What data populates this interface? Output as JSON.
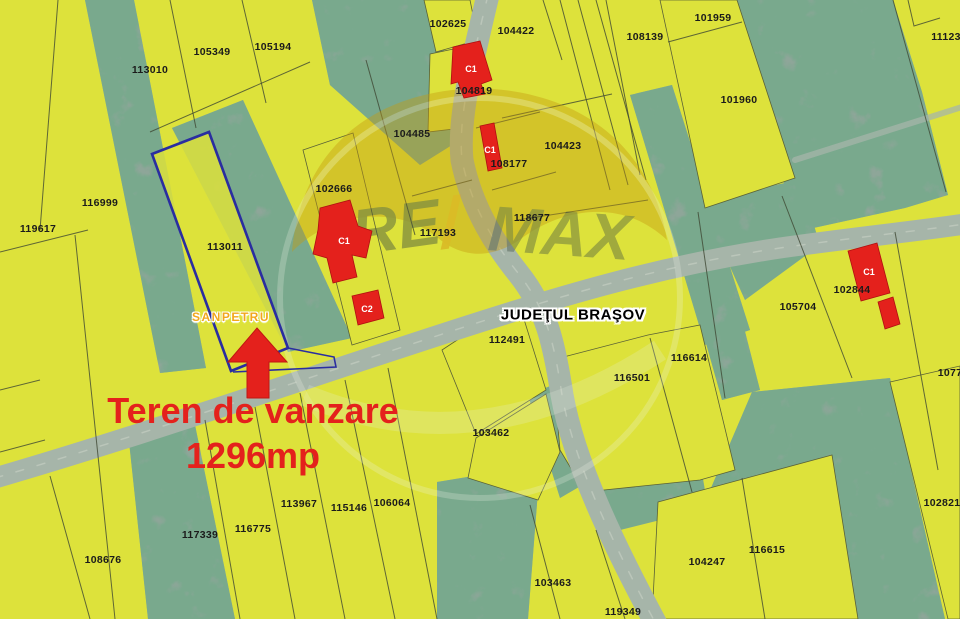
{
  "map": {
    "region_labels": {
      "county": "JUDEŢUL BRAŞOV",
      "locality": "SANPETRU"
    },
    "listing": {
      "line1": "Teren de vanzare",
      "line2": "1296mp"
    },
    "watermark": {
      "re": "RE",
      "slash": "/",
      "max": "MAX"
    },
    "highlighted_parcel": {
      "id": "113011",
      "outline_color": "#2a2da0"
    },
    "parcel_labels": [
      {
        "id": "113010",
        "x": 150,
        "y": 70
      },
      {
        "id": "105349",
        "x": 212,
        "y": 52
      },
      {
        "id": "105194",
        "x": 273,
        "y": 47
      },
      {
        "id": "102625",
        "x": 448,
        "y": 24
      },
      {
        "id": "104422",
        "x": 516,
        "y": 31
      },
      {
        "id": "108139",
        "x": 645,
        "y": 37
      },
      {
        "id": "101959",
        "x": 713,
        "y": 18
      },
      {
        "id": "11123",
        "x": 946,
        "y": 37
      },
      {
        "id": "101960",
        "x": 739,
        "y": 100
      },
      {
        "id": "104819",
        "x": 474,
        "y": 91
      },
      {
        "id": "104485",
        "x": 412,
        "y": 134
      },
      {
        "id": "108177",
        "x": 509,
        "y": 164
      },
      {
        "id": "104423",
        "x": 563,
        "y": 146
      },
      {
        "id": "116999",
        "x": 100,
        "y": 203
      },
      {
        "id": "119617",
        "x": 38,
        "y": 229
      },
      {
        "id": "113011",
        "x": 225,
        "y": 247
      },
      {
        "id": "102666",
        "x": 334,
        "y": 189
      },
      {
        "id": "117193",
        "x": 438,
        "y": 233
      },
      {
        "id": "118677",
        "x": 532,
        "y": 218
      },
      {
        "id": "112491",
        "x": 507,
        "y": 340
      },
      {
        "id": "102844",
        "x": 852,
        "y": 290
      },
      {
        "id": "105704",
        "x": 798,
        "y": 307
      },
      {
        "id": "116614",
        "x": 689,
        "y": 358
      },
      {
        "id": "116501",
        "x": 632,
        "y": 378
      },
      {
        "id": "1077",
        "x": 950,
        "y": 373
      },
      {
        "id": "103462",
        "x": 491,
        "y": 433
      },
      {
        "id": "108676",
        "x": 103,
        "y": 560
      },
      {
        "id": "117339",
        "x": 200,
        "y": 535
      },
      {
        "id": "116775",
        "x": 253,
        "y": 529
      },
      {
        "id": "113967",
        "x": 299,
        "y": 504
      },
      {
        "id": "115146",
        "x": 349,
        "y": 508
      },
      {
        "id": "106064",
        "x": 392,
        "y": 503
      },
      {
        "id": "103463",
        "x": 553,
        "y": 583
      },
      {
        "id": "119349",
        "x": 623,
        "y": 612
      },
      {
        "id": "104247",
        "x": 707,
        "y": 562
      },
      {
        "id": "116615",
        "x": 767,
        "y": 550
      },
      {
        "id": "102821",
        "x": 942,
        "y": 503
      }
    ],
    "building_labels": [
      {
        "label": "C1",
        "x": 471,
        "y": 69
      },
      {
        "label": "C1",
        "x": 490,
        "y": 150
      },
      {
        "label": "C1",
        "x": 344,
        "y": 241
      },
      {
        "label": "C2",
        "x": 367,
        "y": 309
      },
      {
        "label": "C1",
        "x": 869,
        "y": 272
      }
    ],
    "colors": {
      "field_yellow": "#dde23b",
      "vegetation": "#8ea699",
      "road": "#a6b5a9",
      "accent_red": "#e4211c",
      "parcel_outline_navy": "#2a2da0",
      "label_black": "#1b1b1b",
      "locality_orange": "#f2a71b"
    }
  }
}
